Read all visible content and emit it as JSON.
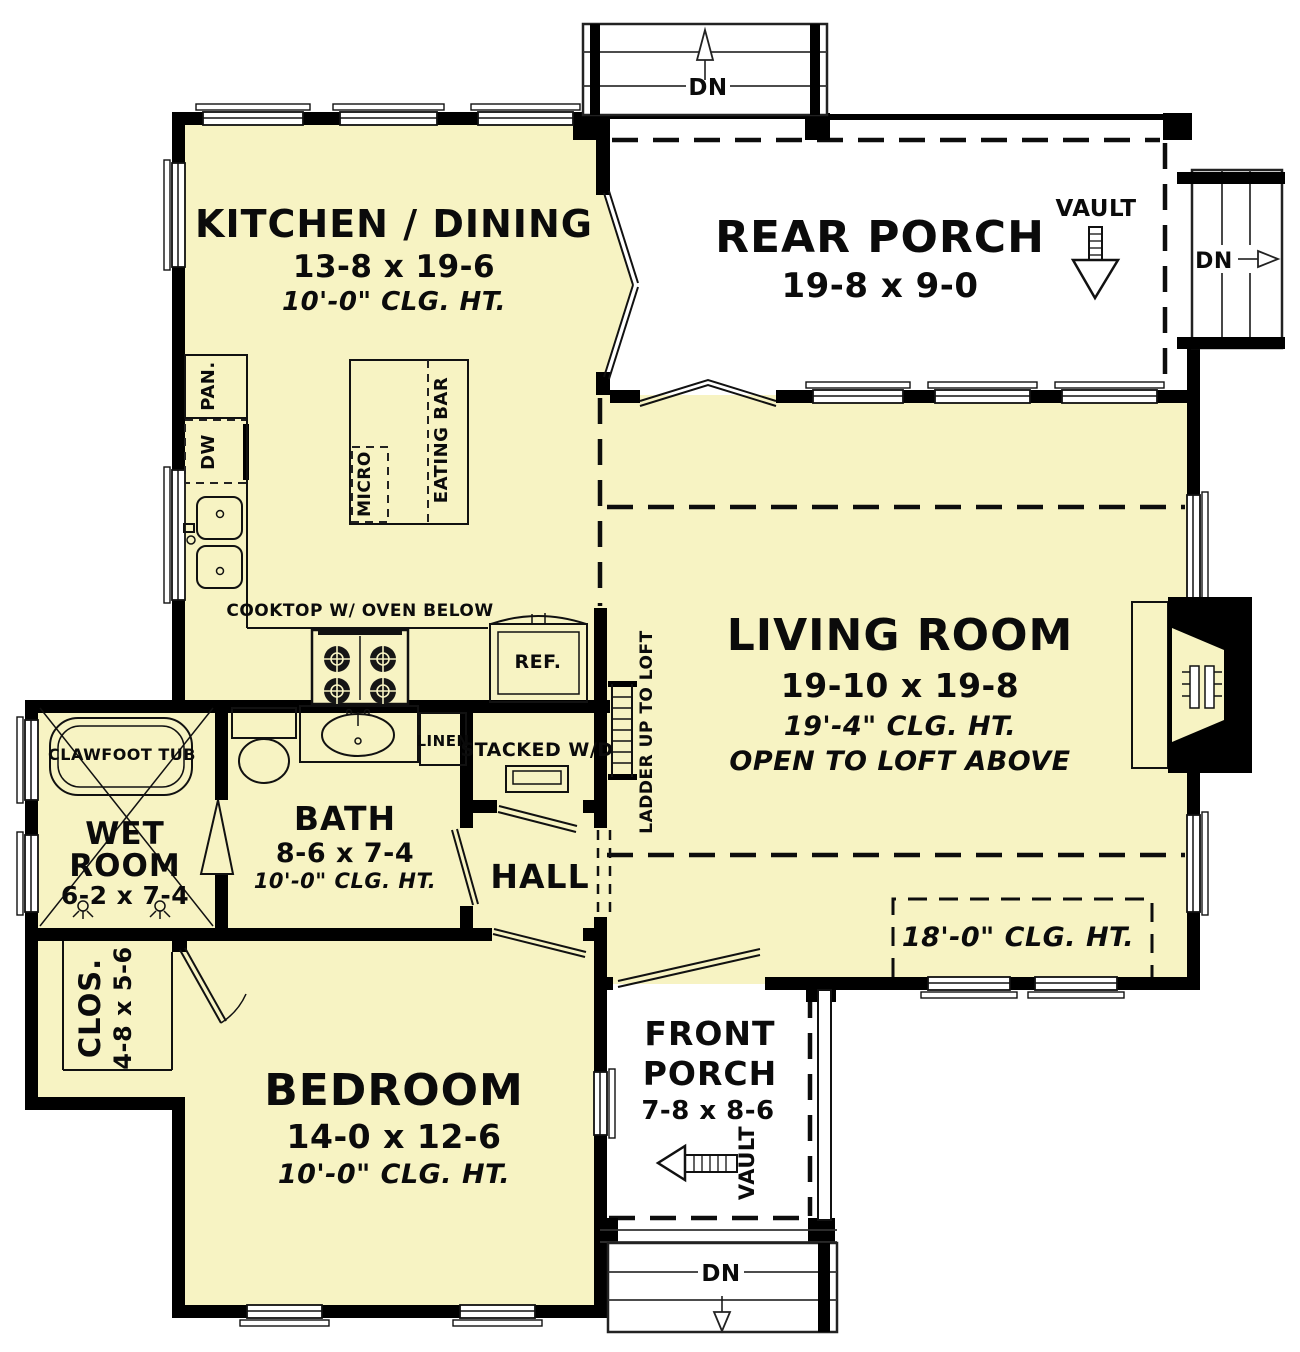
{
  "colors": {
    "room_fill": "#F7F3C3",
    "wall": "#000000",
    "porch_fill": "#FFFFFF"
  },
  "rooms": {
    "kitchen": {
      "name": "KITCHEN / DINING",
      "dims": "13-8 x 19-6",
      "ceiling": "10'-0\" CLG. HT."
    },
    "rear_porch": {
      "name": "REAR PORCH",
      "dims": "19-8 x 9-0"
    },
    "living": {
      "name": "LIVING ROOM",
      "dims": "19-10 x 19-8",
      "ceiling": "19'-4\" CLG. HT.",
      "note": "OPEN TO LOFT ABOVE",
      "corner_ceiling": "18'-0\" CLG. HT."
    },
    "wet_room": {
      "name_line1": "WET",
      "name_line2": "ROOM",
      "dims": "6-2 x 7-4"
    },
    "bath": {
      "name": "BATH",
      "dims": "8-6 x 7-4",
      "ceiling": "10'-0\" CLG. HT."
    },
    "hall": {
      "name": "HALL"
    },
    "closet": {
      "name": "CLOS.",
      "dims": "4-8 x 5-6"
    },
    "bedroom": {
      "name": "BEDROOM",
      "dims": "14-0 x 12-6",
      "ceiling": "10'-0\" CLG. HT."
    },
    "front_porch": {
      "name_line1": "FRONT",
      "name_line2": "PORCH",
      "dims": "7-8 x 8-6"
    }
  },
  "fixtures": {
    "pantry": "PAN.",
    "dishwasher": "DW",
    "microwave": "MICRO",
    "eating_bar": "EATING BAR",
    "cooktop": "COOKTOP W/ OVEN BELOW",
    "refrigerator": "REF.",
    "clawfoot_tub": "CLAWFOOT TUB",
    "linen": "LINEN",
    "stacked_wd": "STACKED W/D",
    "ladder": "LADDER UP TO LOFT"
  },
  "annotations": {
    "vault": "VAULT",
    "down": "DN"
  }
}
